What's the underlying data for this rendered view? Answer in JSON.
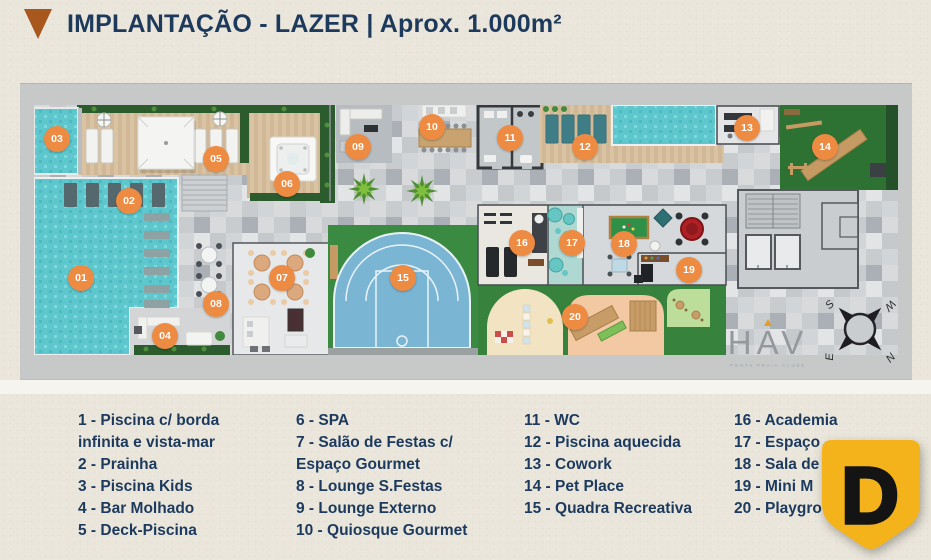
{
  "header": {
    "title": "IMPLANTAÇÃO - LAZER | Aprox. 1.000m²"
  },
  "plan": {
    "markers": [
      {
        "label": "01",
        "x": 61,
        "y": 195
      },
      {
        "label": "02",
        "x": 109,
        "y": 118
      },
      {
        "label": "03",
        "x": 37,
        "y": 56
      },
      {
        "label": "04",
        "x": 145,
        "y": 253
      },
      {
        "label": "05",
        "x": 196,
        "y": 76
      },
      {
        "label": "06",
        "x": 267,
        "y": 101
      },
      {
        "label": "07",
        "x": 262,
        "y": 195
      },
      {
        "label": "08",
        "x": 196,
        "y": 221
      },
      {
        "label": "09",
        "x": 338,
        "y": 64
      },
      {
        "label": "10",
        "x": 412,
        "y": 44
      },
      {
        "label": "11",
        "x": 490,
        "y": 55
      },
      {
        "label": "12",
        "x": 565,
        "y": 64
      },
      {
        "label": "13",
        "x": 727,
        "y": 45
      },
      {
        "label": "14",
        "x": 805,
        "y": 64
      },
      {
        "label": "15",
        "x": 383,
        "y": 195
      },
      {
        "label": "16",
        "x": 502,
        "y": 160
      },
      {
        "label": "17",
        "x": 552,
        "y": 160
      },
      {
        "label": "18",
        "x": 604,
        "y": 161
      },
      {
        "label": "19",
        "x": 669,
        "y": 187
      },
      {
        "label": "20",
        "x": 555,
        "y": 234
      }
    ],
    "logo": {
      "text": "HAV",
      "tagline": "PONTA PRAIA CLUBE"
    },
    "compass": {
      "nw": "S",
      "ne": "W",
      "sw": "E",
      "se": "N"
    }
  },
  "legend": {
    "columns": [
      {
        "items": [
          "1 - Piscina c/ borda infinita e vista-mar",
          "2 - Prainha",
          "3 - Piscina Kids",
          "4 - Bar Molhado",
          "5 - Deck-Piscina"
        ]
      },
      {
        "items": [
          "6 - SPA",
          "7 - Salão de Festas c/ Espaço Gourmet",
          "8 - Lounge S.Festas",
          "9 - Lounge Externo",
          "10 - Quiosque Gourmet"
        ]
      },
      {
        "items": [
          "11 - WC",
          "12 - Piscina aquecida",
          "13 - Cowork",
          "14 - Pet Place",
          "15 - Quadra Recreativa"
        ]
      },
      {
        "items": [
          "16 - Academia",
          "17 - Espaço",
          "18 - Sala de",
          "19 - Mini M",
          "20 - Playgro"
        ]
      }
    ]
  },
  "badge": {
    "letter": "D"
  },
  "colors": {
    "accent_orange": "#EE8B43",
    "navy": "#1C3A5E",
    "triangle_brown": "#A8571D",
    "badge_yellow": "#F5B31B",
    "pool_turquoise": "#5EC7CD",
    "court_blue": "#7AB5D4",
    "lawn_green": "#3A8A42"
  }
}
